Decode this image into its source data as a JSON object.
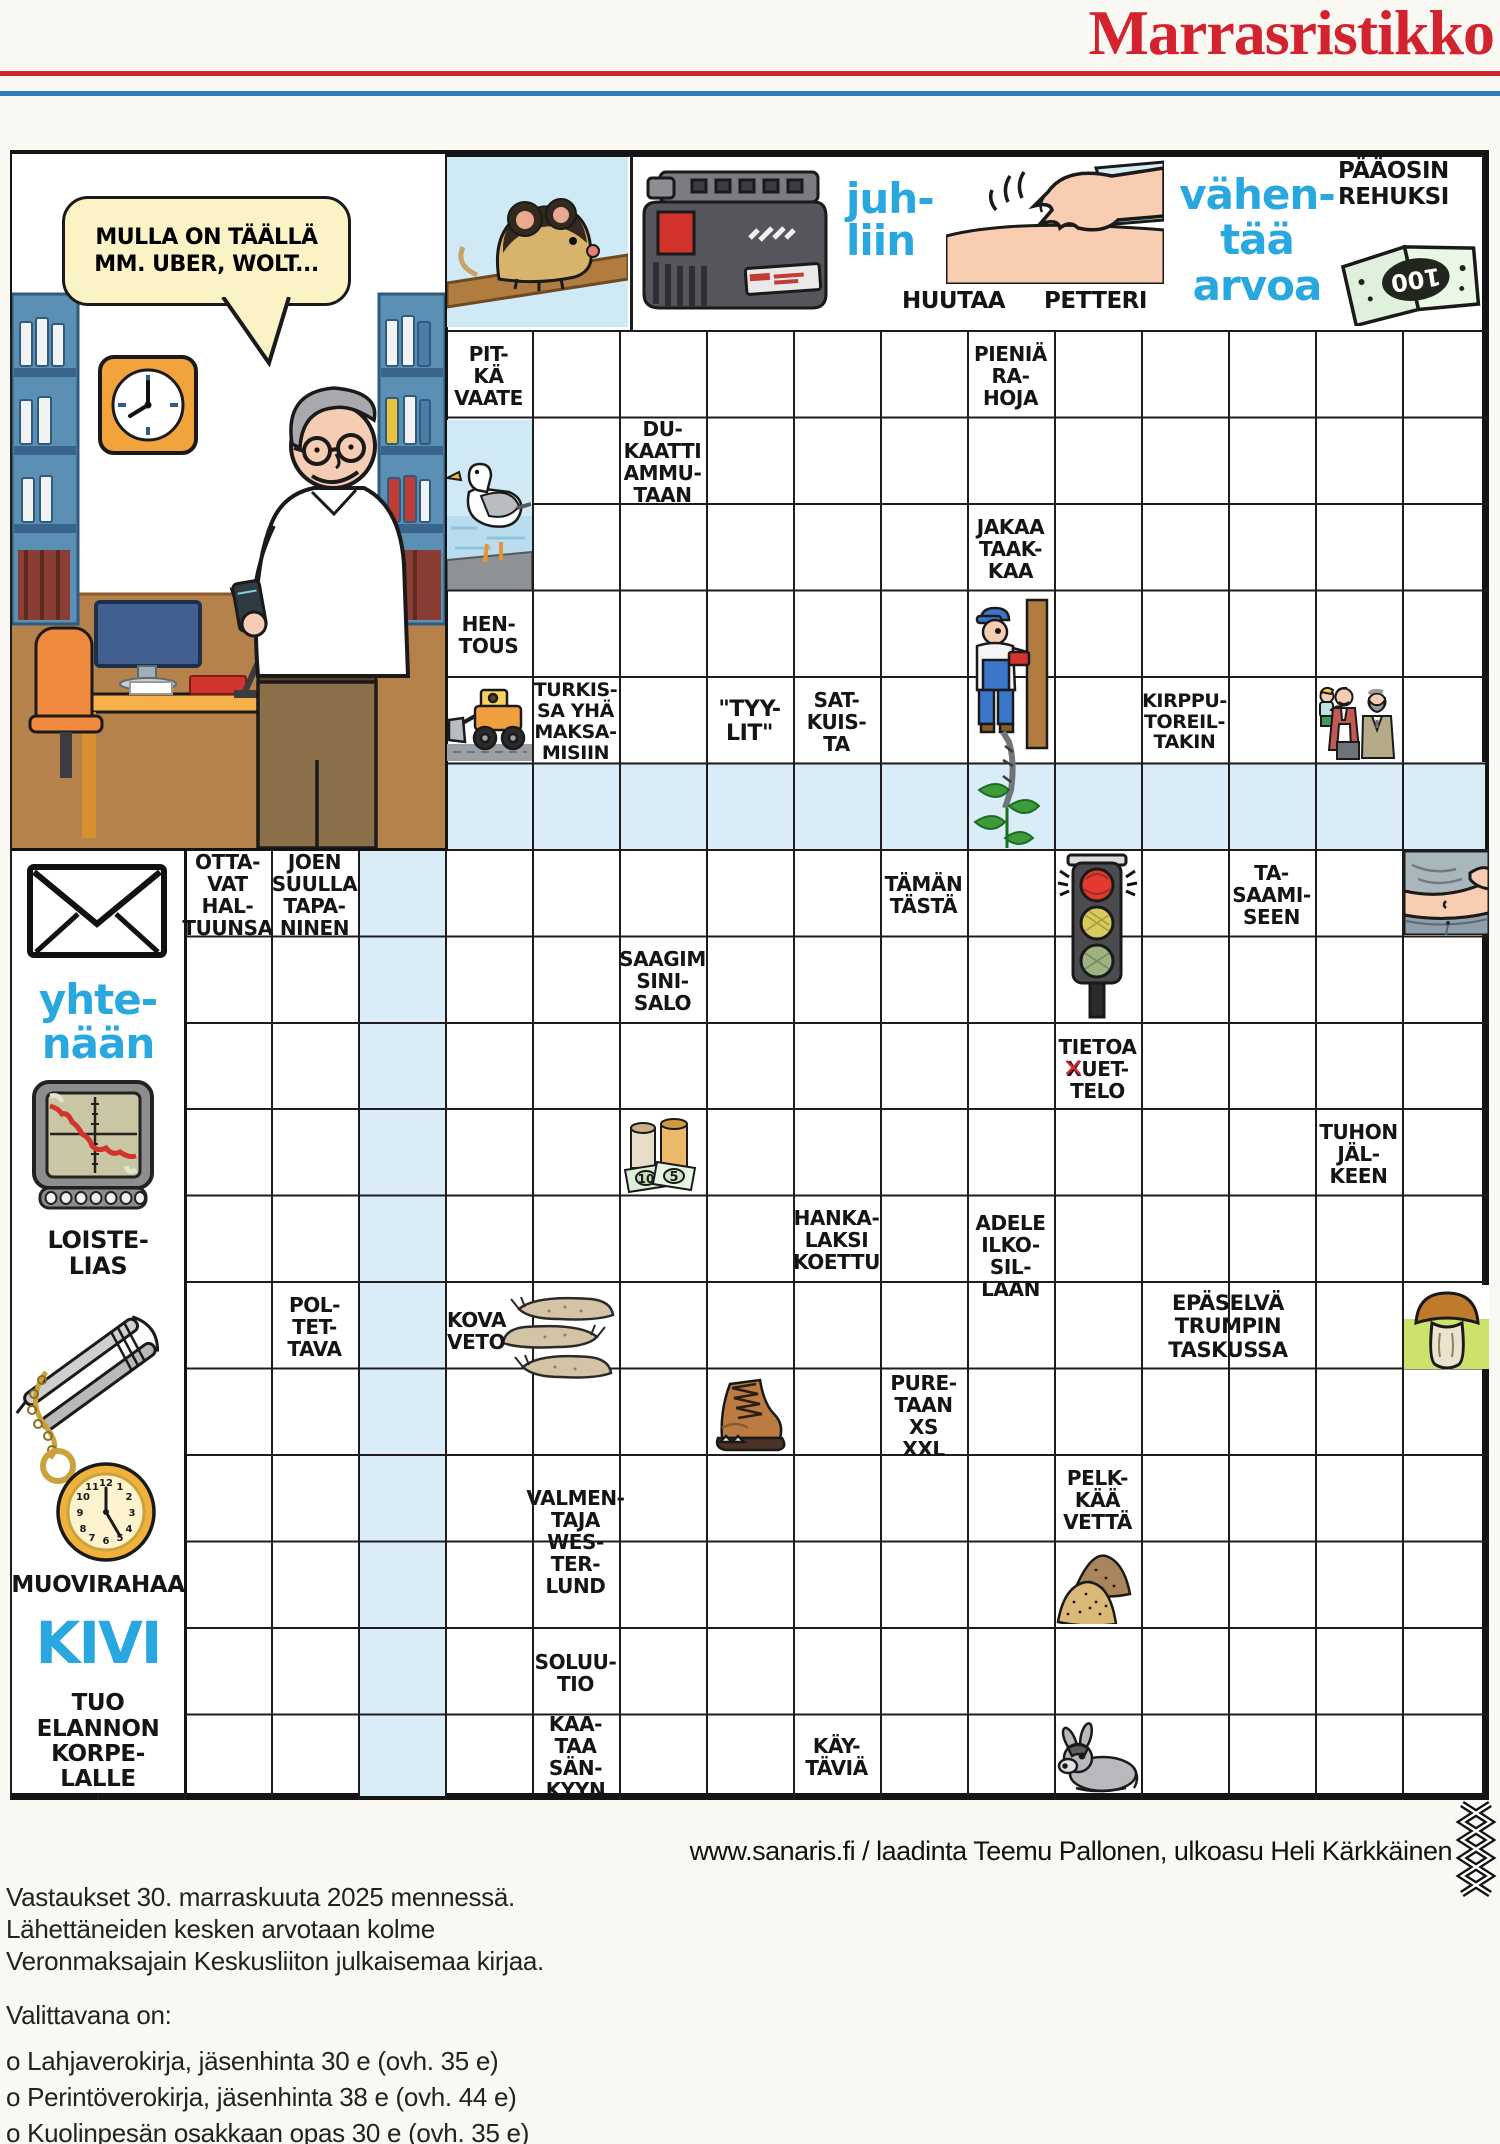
{
  "header": {
    "title": "Marrasristikko"
  },
  "puzzle": {
    "speech_bubble": "MULLA ON TÄÄLLÄ\nMM. UBER, WOLT...",
    "top_labels": {
      "huutaa": "HUUTAA",
      "petteri": "PETTERI",
      "paaosin_rehuksi": "PÄÄOSIN\nREHUKSI"
    },
    "blue_words": {
      "juhliin": "juh-\nliin",
      "vahentaa_arvoa": "vähen-\ntää\narvoa",
      "yhtenaan": "yhte-\nnään",
      "kivi": "KIVI"
    },
    "special_clue": {
      "line1": "TIETOA",
      "crossed": "X",
      "rest": "UET-",
      "line3": "TELO"
    },
    "banknote_value": "100",
    "bill_values": [
      "10",
      "5"
    ],
    "highlight_color": "#d9ecf7",
    "clue_blue_color": "#29a8e0",
    "clues": [
      {
        "id": "pitka-vaate",
        "text": "PIT-\nKÄ\nVAATE"
      },
      {
        "id": "dukaatti",
        "text": "DU-\nKAATTI\nAMMU-\nTAAN"
      },
      {
        "id": "pienia-rahoja",
        "text": "PIENIÄ\nRA-\nHOJA"
      },
      {
        "id": "jakaa-taakkaa",
        "text": "JAKAA\nTAAK-\nKAA"
      },
      {
        "id": "hentous",
        "text": "HEN-\nTOUS"
      },
      {
        "id": "turkissa",
        "text": "TURKIS-\nSA YHÄ\nMAKSA-\nMISIIN"
      },
      {
        "id": "tyylit",
        "text": "\"TYY-\nLIT\""
      },
      {
        "id": "satkuista",
        "text": "SAT-\nKUIS-\nTA"
      },
      {
        "id": "kirpputoreiltakin",
        "text": "KIRPPU-\nTOREIL-\nTAKIN"
      },
      {
        "id": "ottavat-haltuunsa",
        "text": "OTTA-\nVAT\nHAL-\nTUUNSA"
      },
      {
        "id": "joen-suulla",
        "text": "JOEN\nSUULLA\nTAPA-\nNINEN"
      },
      {
        "id": "taman-tasta",
        "text": "TÄMÄN\nTÄSTÄ"
      },
      {
        "id": "ta-saamiseen",
        "text": "TA-\nSAAMI-\nSEEN"
      },
      {
        "id": "saagim",
        "text": "SAAGIM\nSINI-\nSALO"
      },
      {
        "id": "tuhon-jalkeen",
        "text": "TUHON\nJÄL-\nKEEN"
      },
      {
        "id": "hankalaksi",
        "text": "HANKA-\nLAKSI\nKOETTU"
      },
      {
        "id": "adele",
        "text": "ADELE\nILKO-\nSIL-\nLAAN"
      },
      {
        "id": "poltettava",
        "text": "POL-\nTET-\nTAVA"
      },
      {
        "id": "kova-veto",
        "text": "KOVA\nVETO"
      },
      {
        "id": "epaselva",
        "text": "EPÄSELVÄ\nTRUMPIN\nTASKUSSA"
      },
      {
        "id": "puretaan",
        "text": "PURE-\nTAAN\nXS\nXXL"
      },
      {
        "id": "valmentaja",
        "text": "VALMEN-\nTAJA\nWES-\nTER-\nLUND"
      },
      {
        "id": "pelkkaa-vetta",
        "text": "PELK-\nKÄÄ\nVETTÄ"
      },
      {
        "id": "soluutio",
        "text": "SOLUU-\nTIO"
      },
      {
        "id": "kaataa-sankyyn",
        "text": "KAA-\nTAA\nSÄN-\nKYYN"
      },
      {
        "id": "kaytavia",
        "text": "KÄY-\nTÄVIÄ"
      },
      {
        "id": "loistelias",
        "text": "LOISTE-\nLIAS"
      },
      {
        "id": "muovirahaa",
        "text": "MUOVIRAHAA"
      },
      {
        "id": "tuo-elannon",
        "text": "TUO\nELANNON\nKORPE-\nLALLE"
      }
    ],
    "images": [
      {
        "id": "mouse",
        "label": "mouse-on-plank-illustration"
      },
      {
        "id": "battery",
        "label": "power-tool-battery-illustration"
      },
      {
        "id": "hand-tap",
        "label": "hand-patting-shoulder-illustration"
      },
      {
        "id": "banknote",
        "label": "hundred-banknote-illustration"
      },
      {
        "id": "seagull",
        "label": "seagull-on-shore-illustration"
      },
      {
        "id": "bulldozer",
        "label": "wheel-loader-illustration"
      },
      {
        "id": "worker-plant",
        "label": "worker-with-drill-and-plant-illustration"
      },
      {
        "id": "men-duo",
        "label": "man-with-child-and-grandfather-illustration"
      },
      {
        "id": "traffic-light",
        "label": "traffic-light-illustration"
      },
      {
        "id": "belly",
        "label": "bare-belly-illustration"
      },
      {
        "id": "money-cell",
        "label": "coin-rolls-and-banknotes-illustration"
      },
      {
        "id": "slugs",
        "label": "slugs-illustration"
      },
      {
        "id": "boot",
        "label": "worn-boot-illustration"
      },
      {
        "id": "mushroom",
        "label": "porcini-mushroom-illustration"
      },
      {
        "id": "sand-piles",
        "label": "sand-piles-illustration"
      },
      {
        "id": "donkey",
        "label": "donkey-illustration"
      },
      {
        "id": "envelope",
        "label": "envelope-illustration"
      },
      {
        "id": "chart-device",
        "label": "declining-chart-device-illustration"
      },
      {
        "id": "tweezers",
        "label": "tweezers-illustration"
      },
      {
        "id": "pocket-watch",
        "label": "pocket-watch-illustration"
      }
    ]
  },
  "credits": {
    "text": "www.sanaris.fi / laadinta Teemu Pallonen, ulkoasu Heli Kärkkäinen"
  },
  "footer": {
    "lines": [
      "Vastaukset 30. marraskuuta 2025 mennessä.",
      "Lähettäneiden kesken arvotaan kolme",
      "Veronmaksajain Keskusliiton julkaisemaa kirjaa.",
      "Valittavana on:",
      "o Lahjaverokirja, jäsenhinta 30 e (ovh. 35 e)",
      "o Perintöverokirja, jäsenhinta 38 e (ovh. 44 e)",
      "o Kuolinpesän osakkaan opas 30 e (ovh. 35 e)"
    ]
  }
}
